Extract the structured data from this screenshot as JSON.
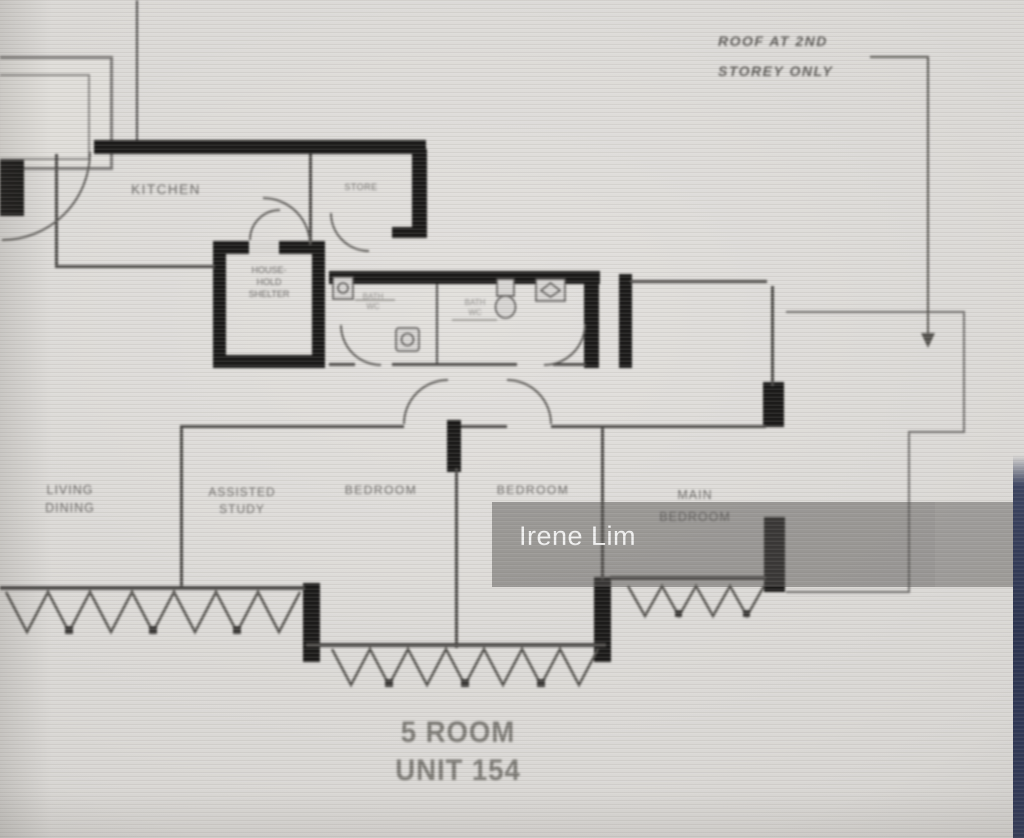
{
  "watermark": {
    "text": "Irene Lim"
  },
  "annotation": {
    "line1": "ROOF AT 2ND",
    "line2": "STOREY ONLY"
  },
  "title": {
    "line1": "5 ROOM",
    "line2": "UNIT 154"
  },
  "rooms": {
    "kitchen": "KITCHEN",
    "store": "STORE",
    "shelter": {
      "l1": "HOUSE-",
      "l2": "HOLD",
      "l3": "SHELTER"
    },
    "bath1": {
      "l1": "BATH",
      "l2": "WC"
    },
    "bath2": {
      "l1": "BATH",
      "l2": "WC"
    },
    "living": {
      "l1": "LIVING",
      "l2": "DINING"
    },
    "study": {
      "l1": "ASSISTED",
      "l2": "STUDY"
    },
    "bedroom1": "BEDROOM",
    "bedroom2": "BEDROOM",
    "main_bedroom": {
      "l1": "MAIN",
      "l2": "BEDROOM"
    }
  },
  "colors": {
    "wall": "#1c1b1a",
    "thin_line": "#4c4a48",
    "label_text": "#6c6a68",
    "photo_background": "#dad8d5",
    "watermark_band": "rgba(86,84,82,0.5)",
    "watermark_text": "#f8f8f8",
    "edge_strip": "#2c3450"
  }
}
